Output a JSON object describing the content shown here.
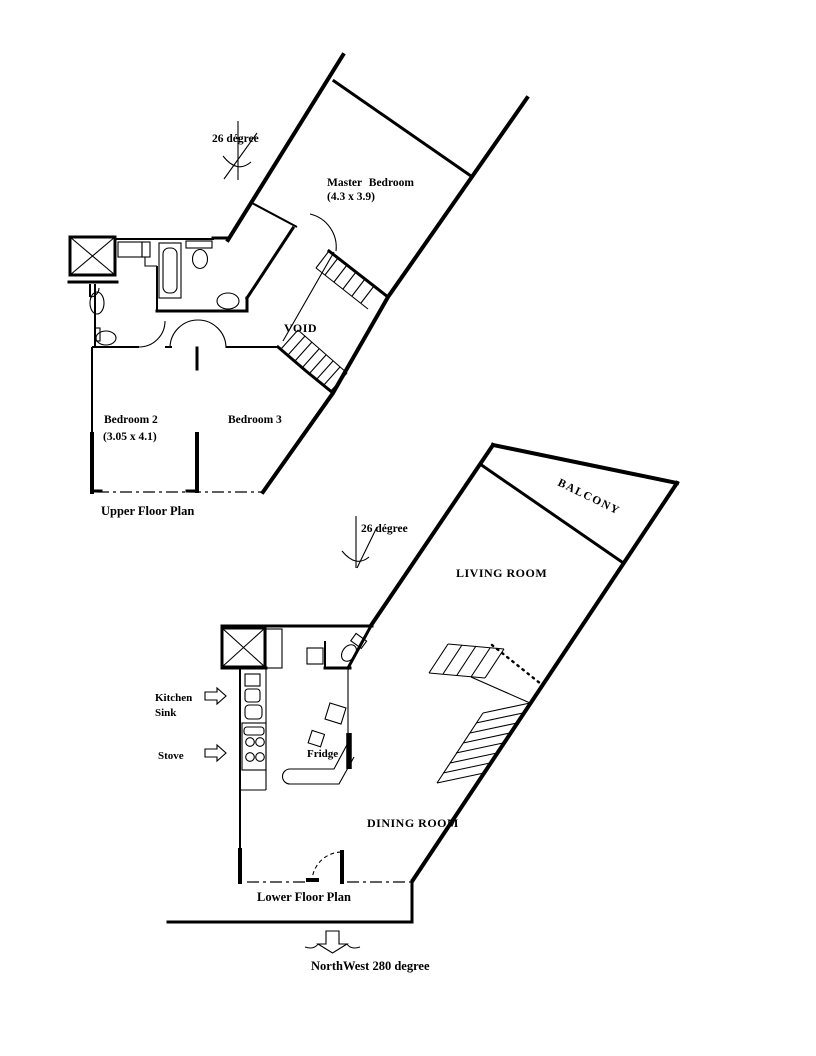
{
  "colors": {
    "ink": "#000000",
    "paper": "#ffffff"
  },
  "upper_plan": {
    "caption": "Upper Floor Plan",
    "angle_annotation": "26 dégree",
    "master_bedroom_name": "Master Bedroom",
    "master_bedroom_dims": "(4.3 x 3.9)",
    "void_label": "VOID",
    "bedroom2_name": "Bedroom 2",
    "bedroom2_dims": "(3.05 x 4.1)",
    "bedroom3_name": "Bedroom 3"
  },
  "lower_plan": {
    "caption": "Lower Floor Plan",
    "angle_annotation": "26 dégree",
    "balcony_label": "BALCONY",
    "living_room_label": "LIVING ROOM",
    "dining_room_label": "DINING ROOM",
    "kitchen_label_line1": "Kitchen",
    "kitchen_label_line2": "Sink",
    "stove_label": "Stove",
    "fridge_label": "Fridge"
  },
  "compass": {
    "direction_label": "NorthWest 280 degree"
  }
}
